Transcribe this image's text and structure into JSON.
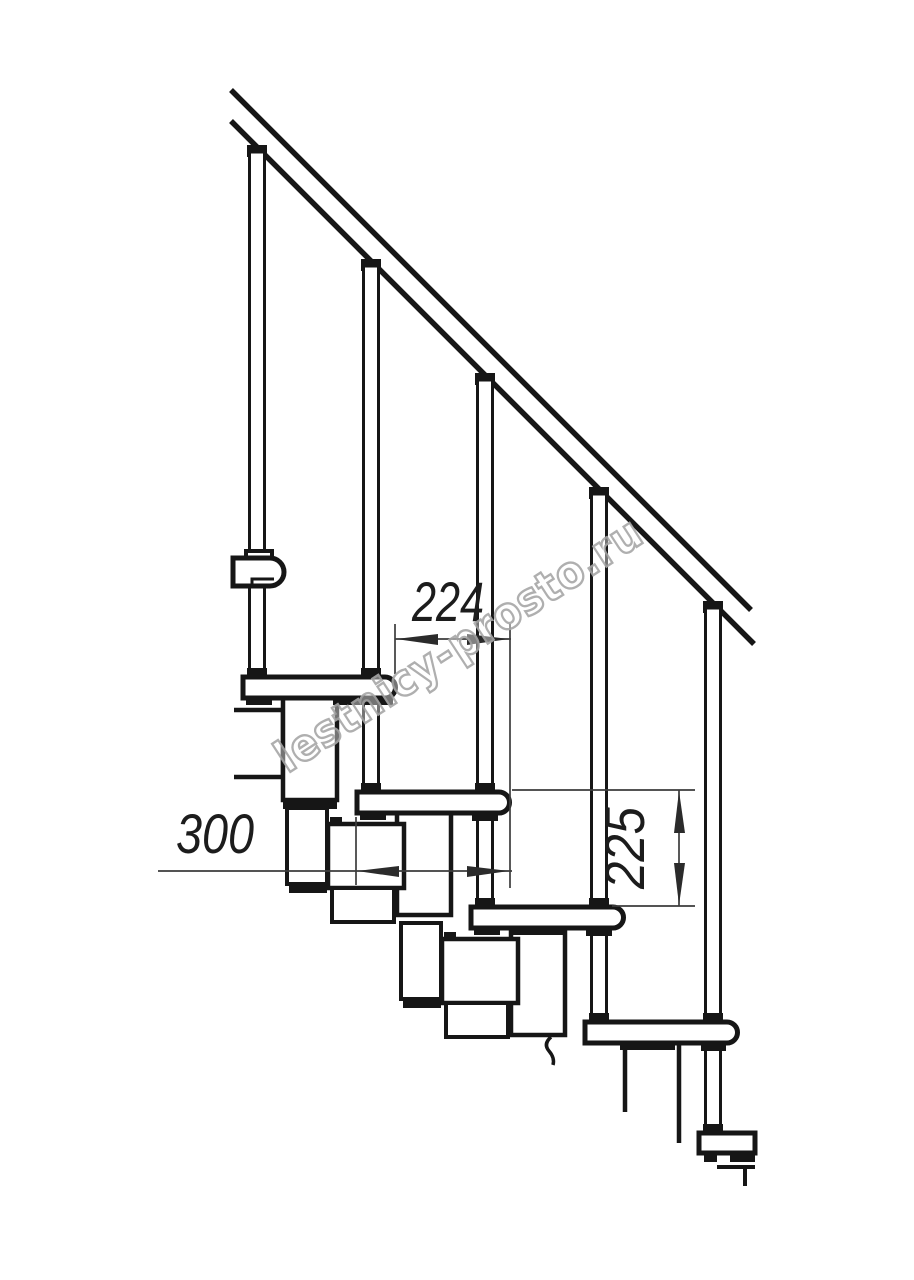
{
  "drawing": {
    "description": "Side-view technical drawing of a modular staircase with handrail and balusters",
    "dimensions": {
      "going": "224",
      "tread_depth": "300",
      "riser_height": "225"
    },
    "watermark": "lestnicy-prosto.ru",
    "colors": {
      "line": "#161616",
      "dimension_line": "#3c3c3c",
      "watermark_stroke": "#a7a7a7",
      "background": "#ffffff"
    }
  }
}
